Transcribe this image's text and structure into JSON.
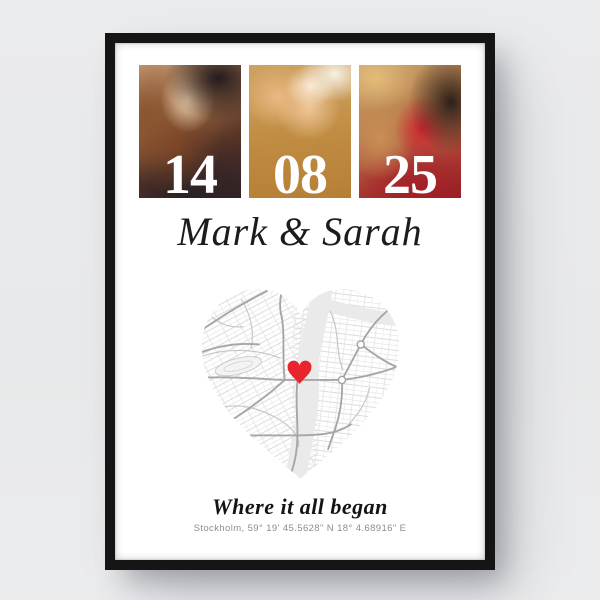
{
  "product": {
    "background_color": "#e9eaec",
    "frame_color": "#151515",
    "poster_color": "#ffffff"
  },
  "poster": {
    "date": {
      "day": "14",
      "month": "08",
      "year": "25"
    },
    "names": "Mark & Sarah",
    "caption": "Where it all began",
    "location": "Stockholm, 59° 19' 45.5628\" N 18° 4.68916\" E",
    "photos": [
      {
        "name": "couple-kissing-photo",
        "description": "couple kissing in warm backlight"
      },
      {
        "name": "pinky-promise-photo",
        "description": "two hands linked by pinky fingers on golden background"
      },
      {
        "name": "couple-with-rose-photo",
        "description": "woman in straw hat and man with red rose"
      }
    ],
    "map": {
      "type": "heart-shaped-street-map",
      "marker": "red-heart",
      "marker_color": "#e8242d",
      "river_color": "#eaeaea",
      "road_color": "#a6a6a6"
    }
  }
}
